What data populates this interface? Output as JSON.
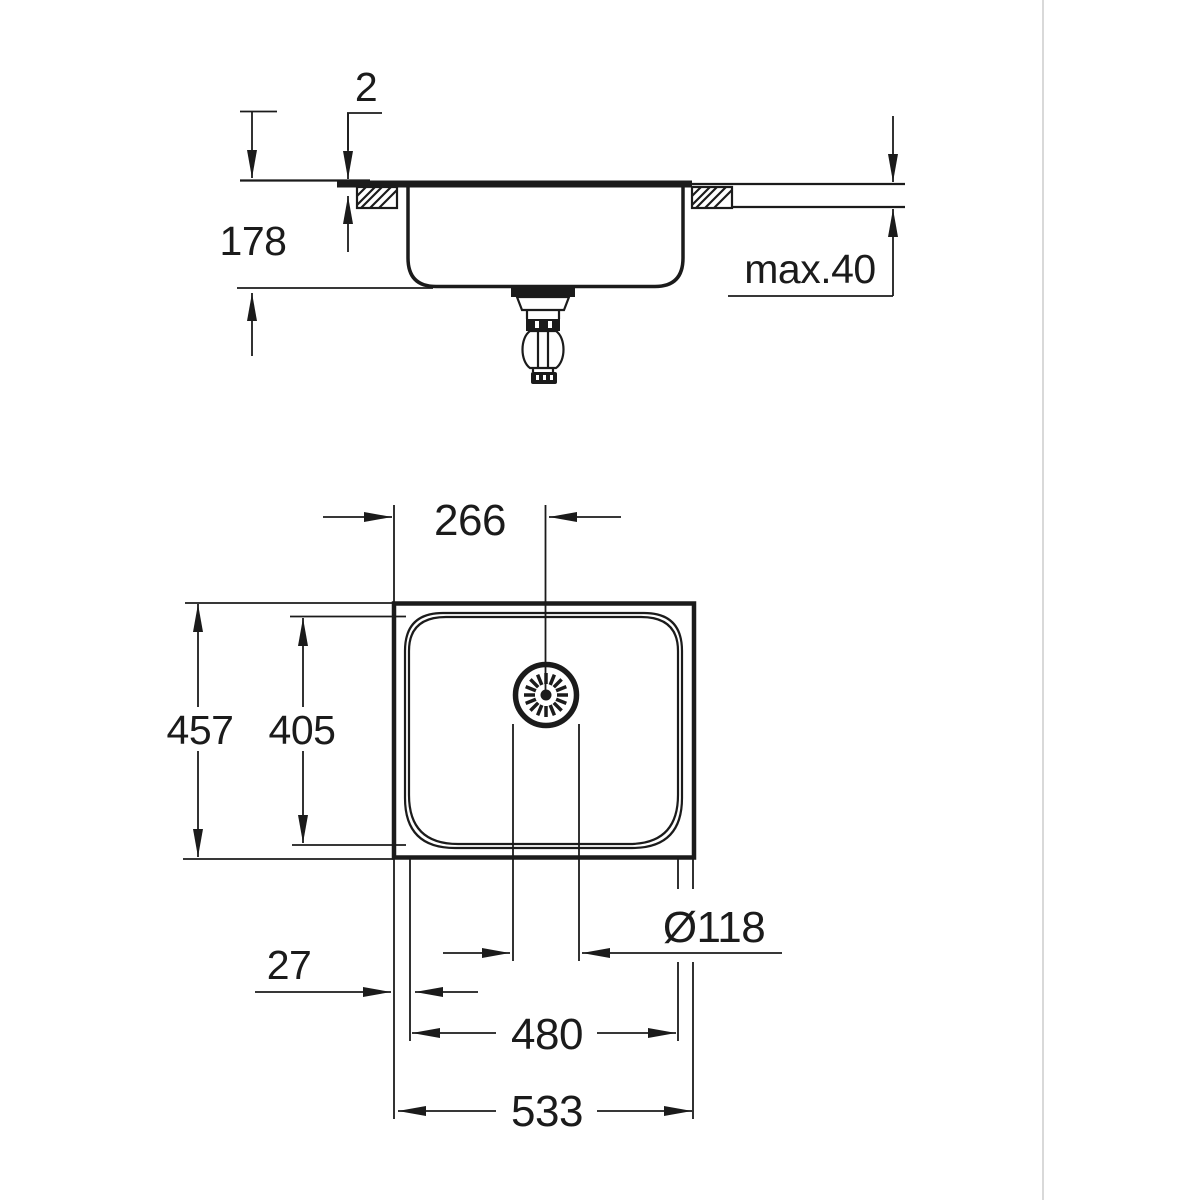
{
  "drawing": {
    "type": "sink technical dimension drawing",
    "colors": {
      "line": "#1b1b1b",
      "background": "#ffffff",
      "frame_line": "#d9d9d9"
    }
  },
  "dims": {
    "rim_height": "2",
    "bowl_depth": "178",
    "counter_max": "max.40",
    "drain_offset": "266",
    "outer_depth": "457",
    "bowl_inner_depth": "405",
    "drain_diameter": "Ø118",
    "edge_offset": "27",
    "bowl_inner_width": "480",
    "outer_width": "533"
  }
}
